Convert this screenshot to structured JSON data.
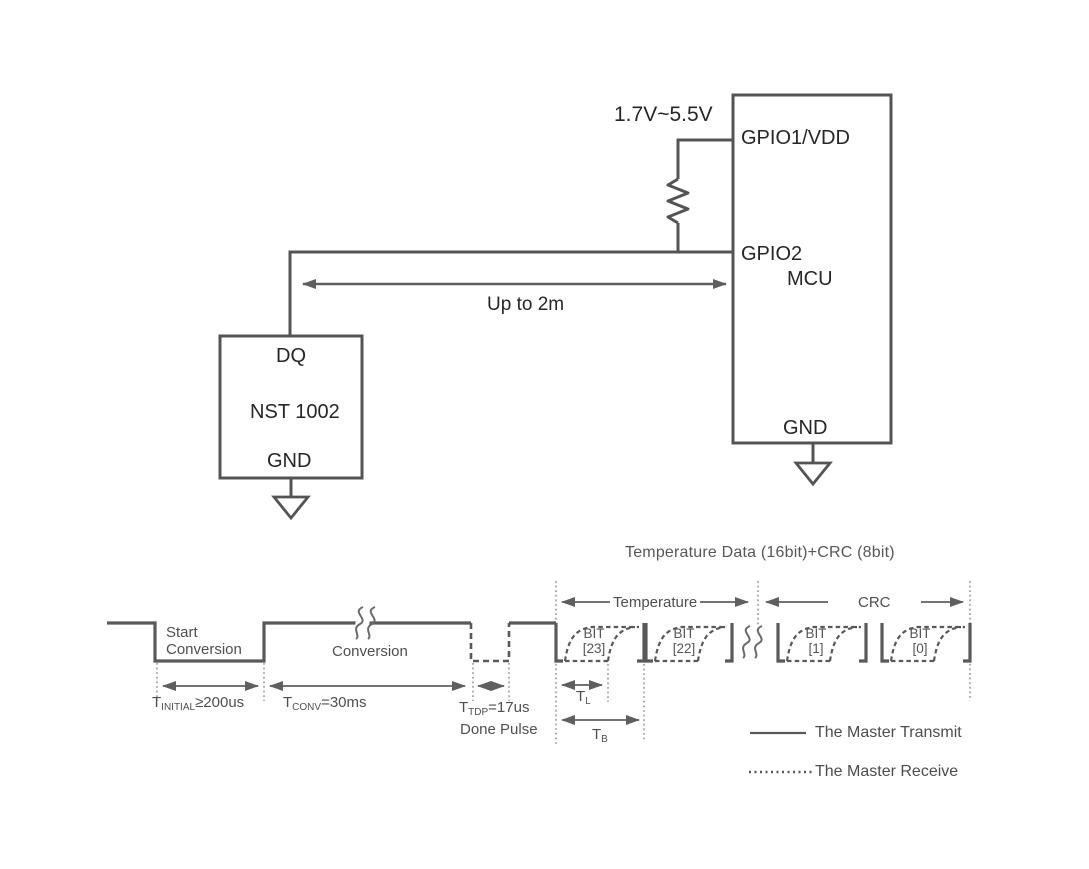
{
  "colors": {
    "wire": "#545454",
    "waveform": "#595959",
    "arrow": "#5f5f5f",
    "guide_dotted": "#8c8c8c",
    "text_dark": "#262626",
    "text_gray": "#4f4f4f",
    "background": "#ffffff"
  },
  "circuit": {
    "supply_label": "1.7V~5.5V",
    "mcu": {
      "pin_top": "GPIO1/VDD",
      "pin_data": "GPIO2",
      "name": "MCU",
      "pin_gnd": "GND"
    },
    "sensor": {
      "pin_data": "DQ",
      "name": "NST 1002",
      "pin_gnd": "GND"
    },
    "cable_label": "Up to 2m"
  },
  "timing": {
    "title": "Temperature Data (16bit)+CRC (8bit)",
    "phase_start": [
      "Start",
      "Conversion"
    ],
    "phase_conversion": "Conversion",
    "t_initial": {
      "pre": "T",
      "sub": "INITIAL",
      "post": "≥200us"
    },
    "t_conv": {
      "pre": "T",
      "sub": "CONV",
      "post": "=30ms"
    },
    "t_tdp": {
      "pre": "T",
      "sub": "TDP",
      "post": "=17us"
    },
    "done_pulse": "Done Pulse",
    "t_l": {
      "pre": "T",
      "sub": "L",
      "post": ""
    },
    "t_b": {
      "pre": "T",
      "sub": "B",
      "post": ""
    },
    "section_temperature": "Temperature",
    "section_crc": "CRC",
    "bits": [
      {
        "label": "BIT",
        "index": "[23]"
      },
      {
        "label": "BIT",
        "index": "[22]"
      },
      {
        "label": "BIT",
        "index": "[1]"
      },
      {
        "label": "BIT",
        "index": "[0]"
      }
    ],
    "legend": [
      {
        "style": "solid",
        "label": "The Master Transmit"
      },
      {
        "style": "dotted",
        "label": "The Master Receive"
      }
    ]
  }
}
